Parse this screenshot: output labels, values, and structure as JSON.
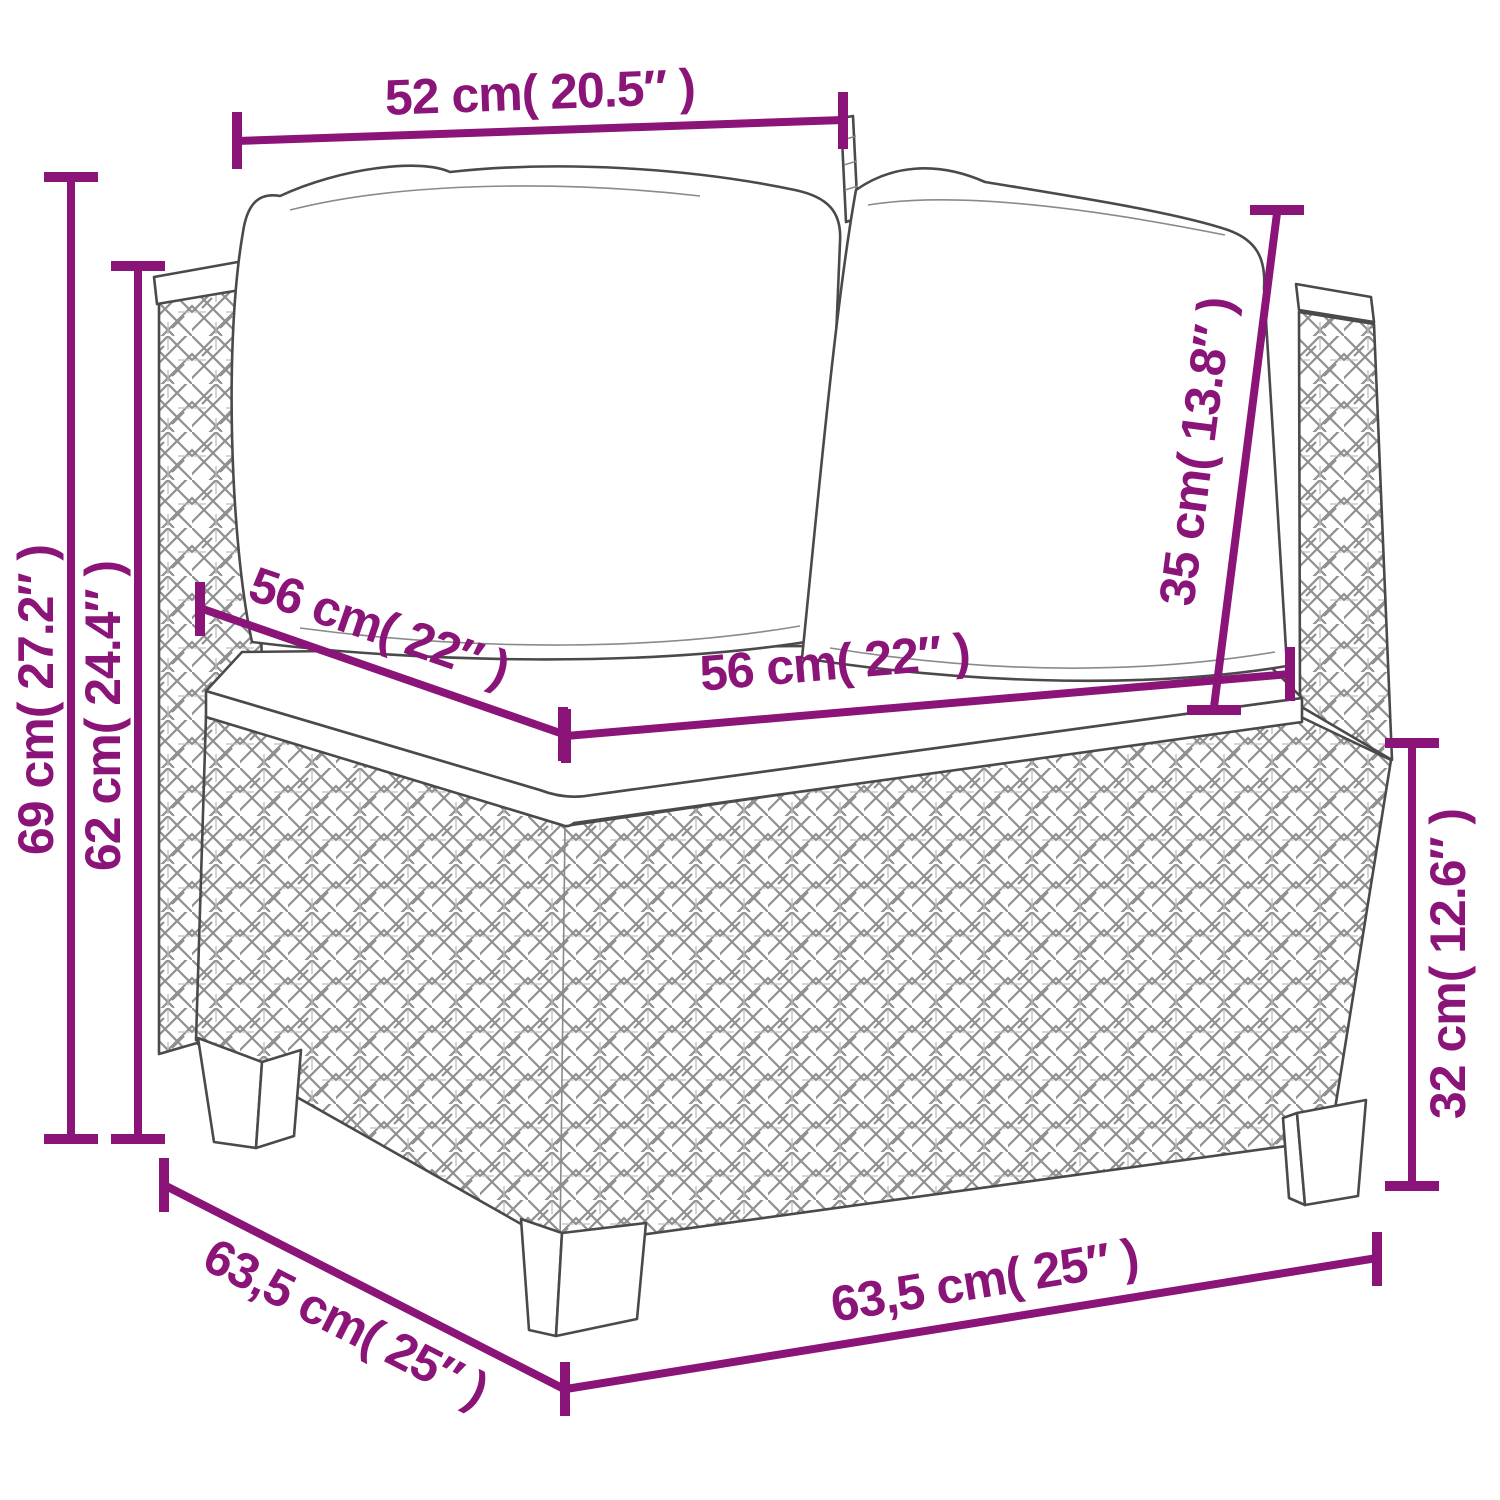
{
  "page": {
    "background": "#ffffff",
    "annotation_color": "#8a1477",
    "line_art_color": "#4a4a4a"
  },
  "diagram": {
    "type": "product-dimension-diagram",
    "subject": "poly rattan corner sofa section with cushions",
    "dimensions": [
      {
        "name": "backrest-top-width",
        "label": "52 cm( 20.5″ )"
      },
      {
        "name": "total-height",
        "label": "69 cm( 27.2″ )"
      },
      {
        "name": "armrest-height",
        "label": "62 cm( 24.4″ )"
      },
      {
        "name": "seat-depth",
        "label": "56 cm( 22″ )"
      },
      {
        "name": "seat-width",
        "label": "56 cm( 22″ )"
      },
      {
        "name": "back-cushion-height",
        "label": "35 cm( 13.8″ )"
      },
      {
        "name": "base-height",
        "label": "32 cm( 12.6″ )"
      },
      {
        "name": "overall-depth",
        "label": "63,5 cm( 25″ )"
      },
      {
        "name": "overall-width",
        "label": "63,5 cm( 25″ )"
      }
    ]
  }
}
